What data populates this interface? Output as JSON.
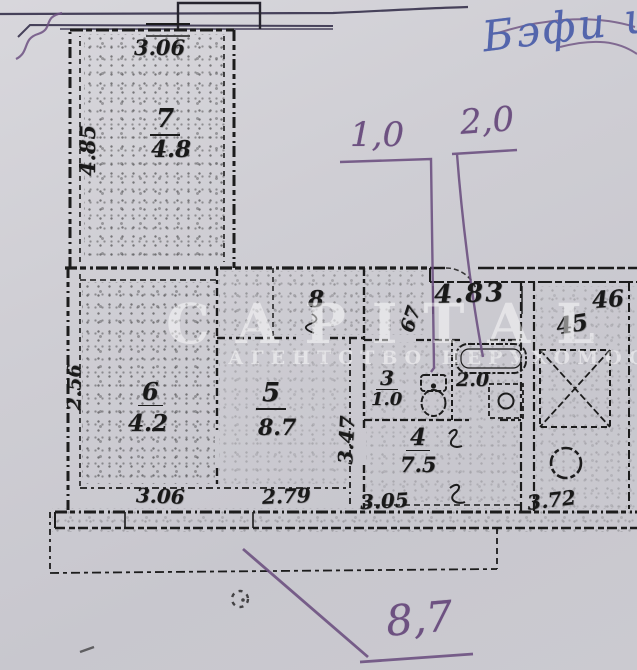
{
  "handwriting": {
    "blue_note": "Бэфи и",
    "dim_left": "1,0",
    "dim_right": "2,0",
    "balcony_area": "8,7"
  },
  "watermark": {
    "line1": "CAPITAL",
    "line2": "АГЕНТСТВО НЕРУХОМОСТІ"
  },
  "plan": {
    "rooms": {
      "r7": {
        "number": "7",
        "area": "4.8",
        "dim_top": "3.06",
        "dim_side": "4.85"
      },
      "r6": {
        "number": "6",
        "area": "4.2",
        "dim_bottom": "3.06",
        "dim_side": "2.56"
      },
      "r5": {
        "number": "5",
        "area": "8.7",
        "dim_bottom": "2.79",
        "dim_side": "3.47"
      },
      "r8": {
        "number": "8",
        "dim_width": "67"
      },
      "r3": {
        "number": "3",
        "area": "1.0"
      },
      "r2": {
        "area": "2.0"
      },
      "r4": {
        "number": "4",
        "area": "7.5",
        "dim_bottom": "3.05"
      }
    },
    "common": {
      "dim_top": "4.83",
      "unit_a": "46",
      "unit_b": "45",
      "dim_bottom": "3.72"
    }
  },
  "colors": {
    "paper": "#cdccd2",
    "ink": "#1c1c1c",
    "purple_pen": "#6d5181",
    "blue_pen": "#5365ac"
  }
}
